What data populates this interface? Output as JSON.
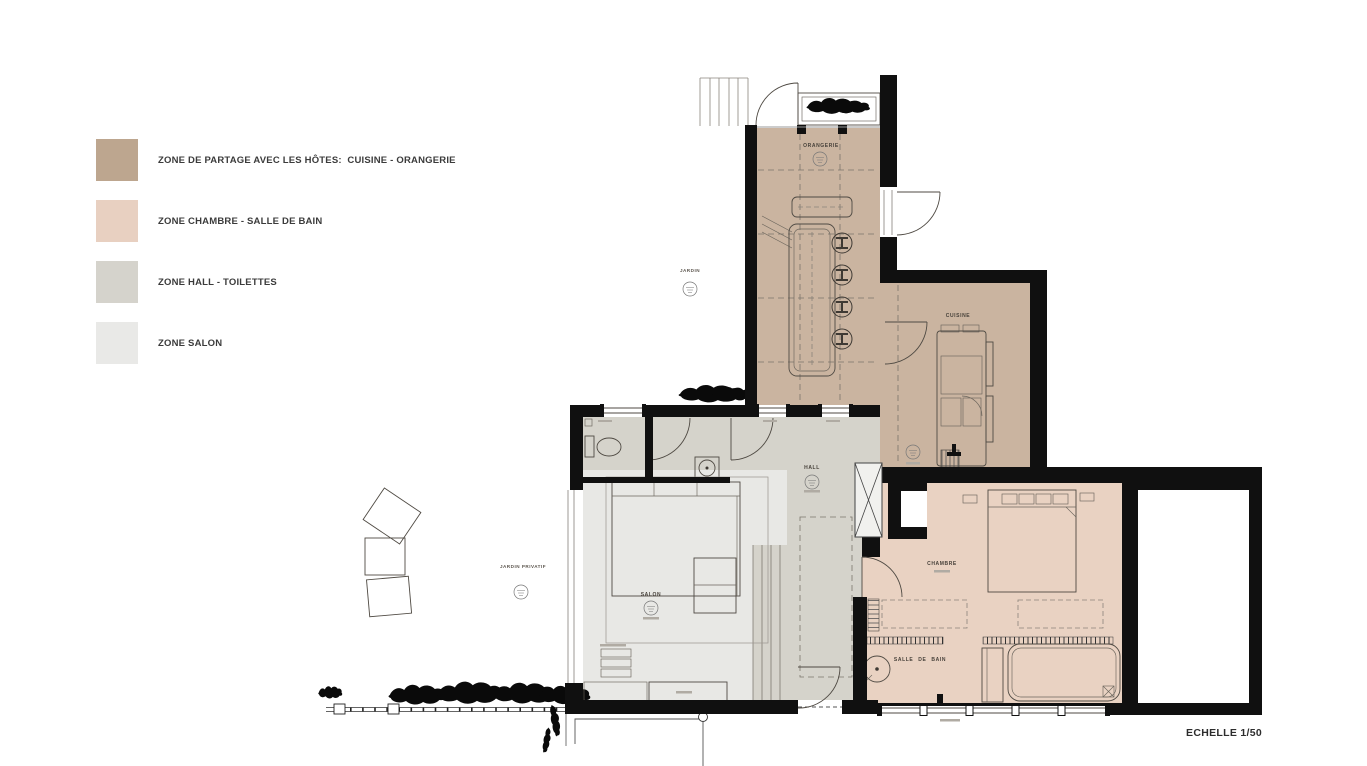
{
  "legend": {
    "items": [
      {
        "id": "zone-partage",
        "label": "ZONE DE PARTAGE AVEC LES HÔTES:  CUISINE - ORANGERIE",
        "color": "#bda68f"
      },
      {
        "id": "zone-chambre",
        "label": "ZONE CHAMBRE - SALLE DE BAIN",
        "color": "#e8d0c1"
      },
      {
        "id": "zone-hall",
        "label": "ZONE HALL - TOILETTES",
        "color": "#d5d3cc"
      },
      {
        "id": "zone-salon",
        "label": "ZONE SALON",
        "color": "#e9e9e7"
      }
    ]
  },
  "plan": {
    "room_labels": {
      "orangerie": "ORANGERIE",
      "cuisine": "CUISINE",
      "hall": "HALL",
      "salon": "SALON",
      "chambre": "CHAMBRE",
      "salle_de_bain": "SALLE DE BAIN"
    },
    "outdoor_labels": {
      "jardin": "JARDIN",
      "jardin_privatif": "JARDIN PRIVATIF"
    }
  },
  "footer": {
    "scale_label": "ECHELLE 1/50"
  },
  "colors": {
    "zone_partage_fill": "#cab4a0",
    "zone_chambre_fill": "#e9d2c2",
    "zone_hall_fill": "#d5d3cb",
    "zone_salon_fill": "#e8e8e5",
    "wall": "#101010",
    "background": "#ffffff"
  }
}
